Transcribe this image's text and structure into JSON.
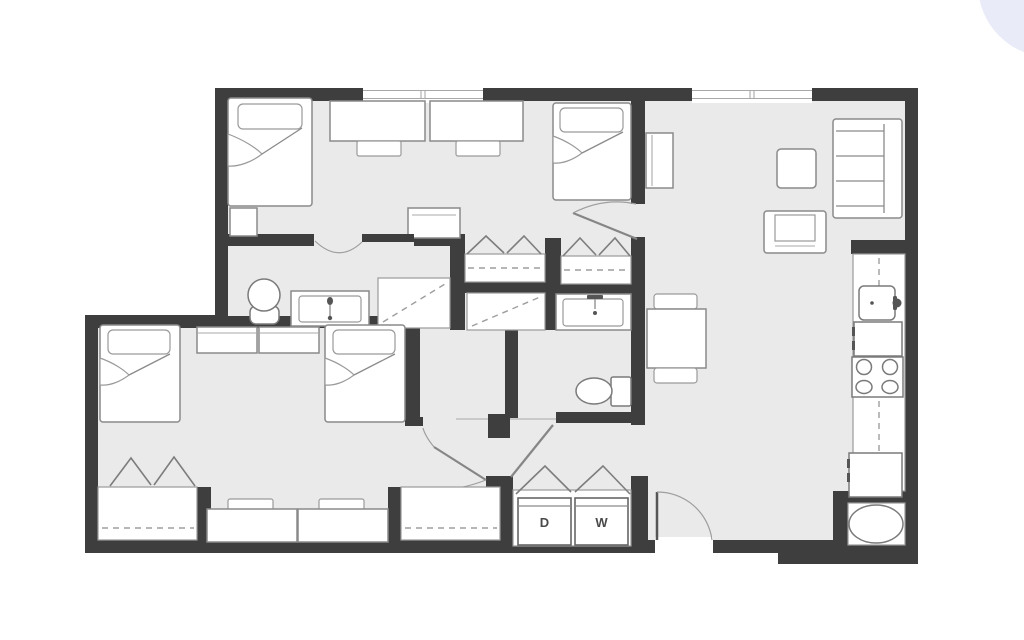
{
  "page": {
    "background_color": "#ffffff",
    "decor_blob_color": "#e9ecf8"
  },
  "floorplan": {
    "type": "apartment-floor-plan",
    "wall_color": "#3e3e3e",
    "floor_color": "#eaeaea",
    "fixture_stroke_color": "#7a7a7a",
    "labels": {
      "dryer": "D",
      "washer": "W"
    },
    "rooms": [
      {
        "name": "bedroom-upper",
        "furniture": [
          "bed",
          "bed",
          "desk",
          "desk",
          "chair",
          "chair",
          "nightstand",
          "side-table"
        ]
      },
      {
        "name": "closets-upper",
        "features": [
          "bifold-closet",
          "bifold-closet",
          "hanging-rods"
        ]
      },
      {
        "name": "bathroom-left",
        "fixtures": [
          "toilet",
          "sink-vanity",
          "shower"
        ]
      },
      {
        "name": "bathroom-right",
        "fixtures": [
          "toilet",
          "sink-vanity",
          "shower"
        ]
      },
      {
        "name": "living-room",
        "furniture": [
          "sofa",
          "coffee-table",
          "armchair",
          "console"
        ]
      },
      {
        "name": "dining-area",
        "furniture": [
          "dining-table",
          "chair",
          "chair"
        ]
      },
      {
        "name": "kitchen",
        "fixtures": [
          "sink",
          "dishwasher",
          "range",
          "refrigerator",
          "water-heater"
        ]
      },
      {
        "name": "laundry-closet",
        "appliances": [
          "dryer",
          "washer"
        ]
      },
      {
        "name": "bedroom-lower",
        "furniture": [
          "bed",
          "bed",
          "dresser",
          "dresser",
          "desk",
          "desk",
          "chair",
          "chair",
          "closet",
          "closet"
        ]
      },
      {
        "name": "entry",
        "features": [
          "entry-door"
        ]
      }
    ]
  }
}
